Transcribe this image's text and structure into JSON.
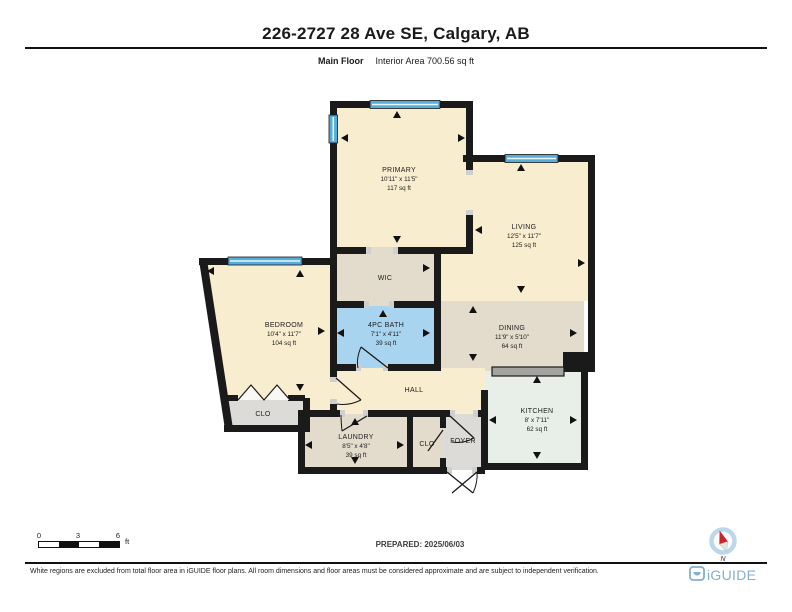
{
  "header": {
    "title": "226-2727 28 Ave SE, Calgary, AB",
    "floor_label": "Main Floor",
    "area_label": "Interior Area 700.56 sq ft"
  },
  "rooms": {
    "primary": {
      "name": "PRIMARY",
      "dims": "10'11\" x 11'5\"",
      "area": "117 sq ft"
    },
    "living": {
      "name": "LIVING",
      "dims": "12'5\" x 11'7\"",
      "area": "125 sq ft"
    },
    "bedroom": {
      "name": "BEDROOM",
      "dims": "10'4\" x 11'7\"",
      "area": "104 sq ft"
    },
    "wic": {
      "name": "WIC"
    },
    "bath": {
      "name": "4PC BATH",
      "dims": "7'1\" x 4'11\"",
      "area": "39 sq ft"
    },
    "dining": {
      "name": "DINING",
      "dims": "11'9\" x 5'10\"",
      "area": "64 sq ft"
    },
    "hall": {
      "name": "HALL"
    },
    "closet_bedroom": {
      "name": "CLO"
    },
    "laundry": {
      "name": "LAUNDRY",
      "dims": "8'5\" x 4'8\"",
      "area": "39 sq ft"
    },
    "closet_hall": {
      "name": "CLO"
    },
    "foyer": {
      "name": "FOYER"
    },
    "kitchen": {
      "name": "KITCHEN",
      "dims": "8' x 7'11\"",
      "area": "62 sq ft"
    }
  },
  "scale_bar": {
    "ticks": [
      "0",
      "3",
      "6"
    ],
    "unit": "ft"
  },
  "prepared_label": "PREPARED: 2025/06/03",
  "compass_label": "N",
  "footer": {
    "disclaimer": "White regions are excluded from total floor area in iGUIDE floor plans. All room dimensions and floor areas must be considered approximate and are subject to independent verification.",
    "brand": "iGUIDE"
  },
  "colors": {
    "wall": "#1a1a1a",
    "room_cream": "#f9edcf",
    "room_tan": "#e3dccd",
    "room_grey": "#dcdbd7",
    "bath_blue": "#a9d4ef",
    "kitchen_mint": "#e8efe8",
    "window_blue": "#56aed8",
    "counter_grey": "#a3a3a1",
    "brand_blue": "#84aed2",
    "compass_red": "#c9252b"
  }
}
